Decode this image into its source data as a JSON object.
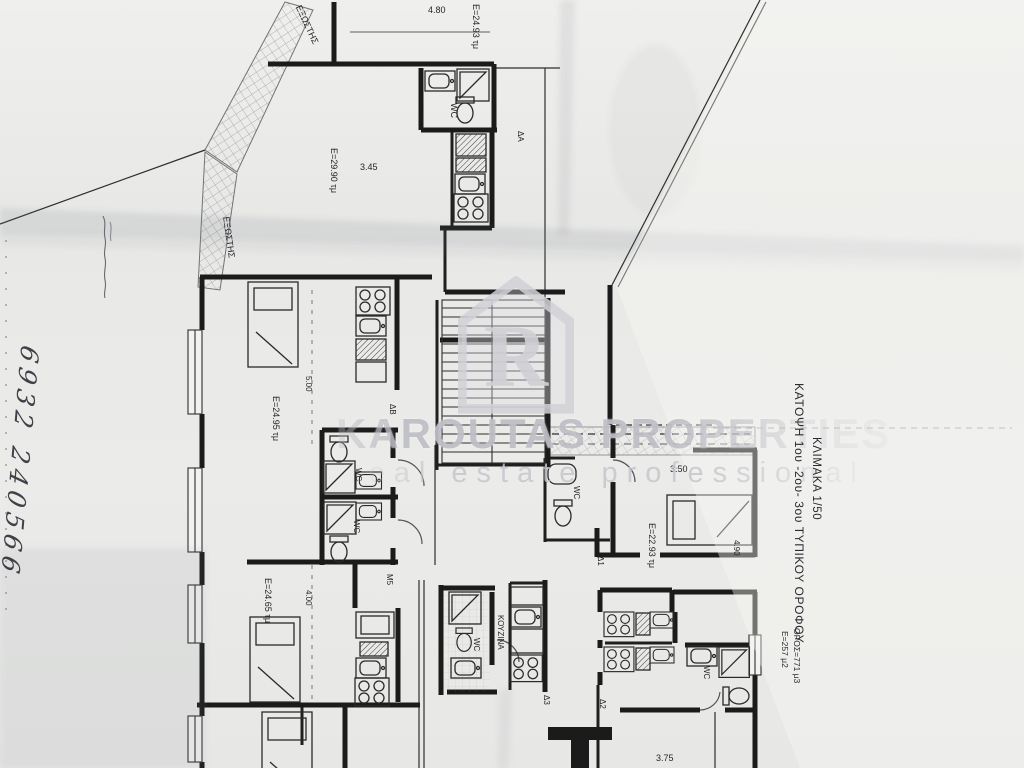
{
  "watermark": {
    "logo_letter": "R",
    "brand": "KAROUTAS PROPERTIES",
    "tagline": "real estate professional"
  },
  "title_block": {
    "line1": "ΚΑΤΟΨΗ 1ου -2ου- 3ου ΤΥΠΙΚΟΥ ΟΡΟΦΟΥ",
    "line2": "ΚΛΙΜΑΚΑ 1/50",
    "area_total": "Ε=257 μ2",
    "volume_total": "ΟΡΟΣ=771 μ3"
  },
  "handwritten_note": "6932 240566",
  "plan": {
    "balconies": {
      "top": "ΕΞΩΣΤΗΣ",
      "left": "ΕΞΩΣΤΗΣ"
    },
    "areas": {
      "top_unit": "Ε=24.93 τμ",
      "upper_left_unit": "Ε=29.90 τμ",
      "mid_left_unit": "Ε=24.95 τμ",
      "right_unit": "Ε=22.93 τμ",
      "lower_left_unit": "Ε=24.65 τμ"
    },
    "dimensions": {
      "top_width": "4.80",
      "upper_width": "3.45",
      "mid_height": "5.00",
      "right_width": "3.50",
      "right_height": "4.90",
      "lower_height": "4.00",
      "bottom_width": "3.75"
    },
    "room_labels": {
      "wc": "WC",
      "kitchen": "ΚΟΥΖΙΝΑ"
    },
    "unit_labels": {
      "da": "ΔΑ",
      "db": "ΔΒ",
      "d1": "Δ1",
      "d2": "Δ2",
      "d3": "Δ3",
      "m5": "Μ5"
    }
  }
}
